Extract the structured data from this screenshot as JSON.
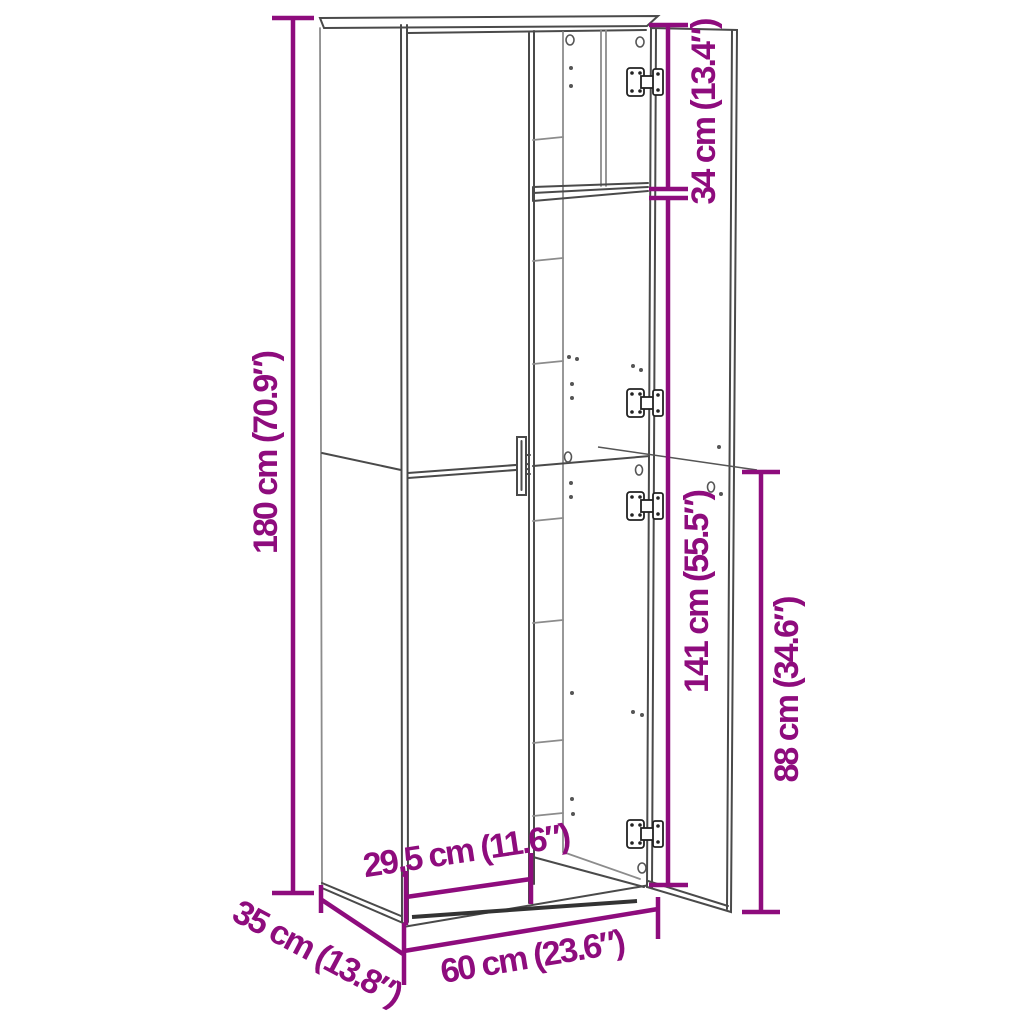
{
  "diagram": {
    "title": "Cabinet dimension diagram",
    "object": "Tall two-door cabinet shown with right door open",
    "labels": {
      "height_total": "180 cm (70.9″)",
      "section_top": "34 cm (13.4″)",
      "section_interior": "141 cm (55.5″)",
      "section_lower": "88 cm (34.6″)",
      "opening_width": "29,5 cm (11.6″)",
      "width_total": "60 cm (23.6″)",
      "depth": "35 cm (13.8″)"
    },
    "colors": {
      "dimension": "#8E0C7D",
      "line": "#4A4A4A",
      "line_light": "#8C8C8C",
      "background": "#FFFFFF"
    }
  }
}
